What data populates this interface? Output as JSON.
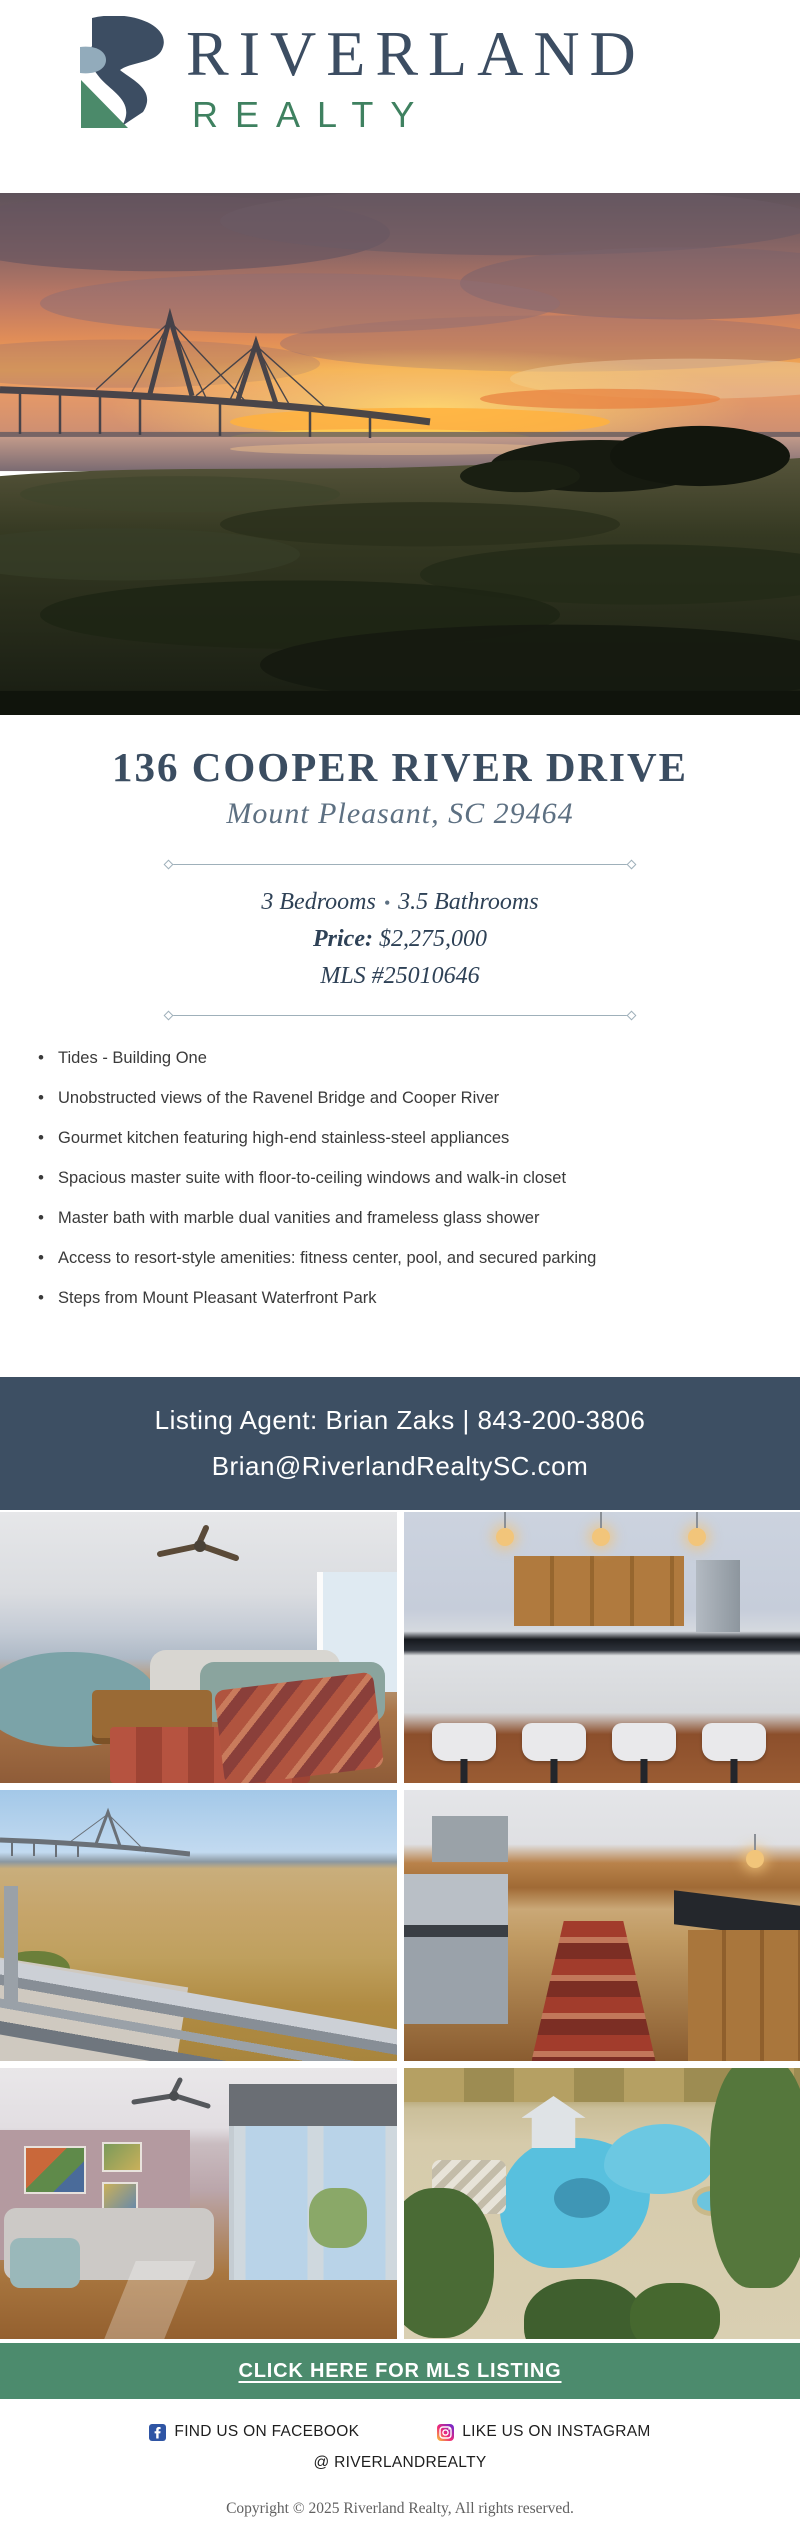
{
  "logo": {
    "brand_top": "RIVERLAND",
    "brand_bottom": "REALTY"
  },
  "colors": {
    "navy": "#3D4F63",
    "brand_green": "#3F8160",
    "cta_green": "#4C8B6D",
    "logo_light_blue": "#92ABBB"
  },
  "listing": {
    "address": "136 COOPER RIVER DRIVE",
    "city": "Mount Pleasant, SC 29464",
    "beds": "3 Bedrooms",
    "separator": "•",
    "baths": "3.5 Bathrooms",
    "price_label": "Price:",
    "price": " $2,275,000",
    "mls": "MLS #25010646"
  },
  "features": [
    "Tides - Building One",
    "Unobstructed views of the Ravenel Bridge and Cooper River",
    "Gourmet kitchen featuring high-end stainless-steel appliances",
    "Spacious master suite with floor-to-ceiling windows and walk-in closet",
    "Master bath with marble dual vanities and frameless glass shower",
    "Access to resort-style amenities: fitness center, pool, and secured parking",
    "Steps from Mount Pleasant Waterfront Park"
  ],
  "agent": {
    "line1": "Listing Agent: Brian Zaks | 843-200-3806",
    "email": "Brian@RiverlandRealtySC.com"
  },
  "cta": {
    "label": "CLICK HERE FOR MLS LISTING"
  },
  "footer": {
    "facebook_label": "FIND US ON FACEBOOK",
    "instagram_label": "LIKE US ON INSTAGRAM",
    "handle": "@ RIVERLANDREALTY",
    "copyright": "Copyright © 2025  Riverland Realty, All rights reserved."
  },
  "icons": {
    "facebook": "facebook-f-square",
    "instagram": "instagram-camera-square"
  }
}
